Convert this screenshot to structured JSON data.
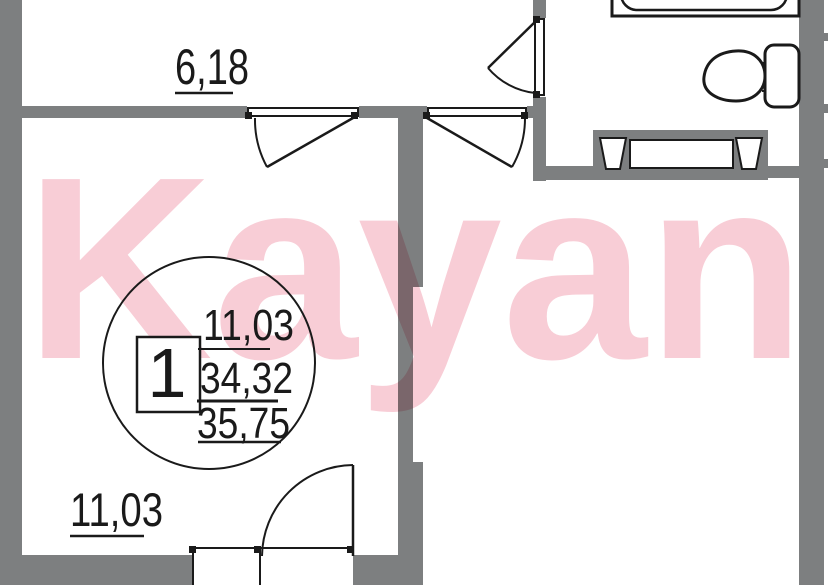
{
  "plan": {
    "watermark_text": "Kayan",
    "labels": {
      "hallway_area": "6,18",
      "living_room_area": "11,03"
    },
    "info_circle": {
      "apartment_number": "1",
      "living_area": "11,03",
      "apartment_area": "34,32",
      "total_area": "35,75"
    },
    "colors": {
      "wall": "#7d7f80",
      "line": "#1a1a1a",
      "pink": "#f8cdd6",
      "paper": "#ffffff"
    }
  }
}
